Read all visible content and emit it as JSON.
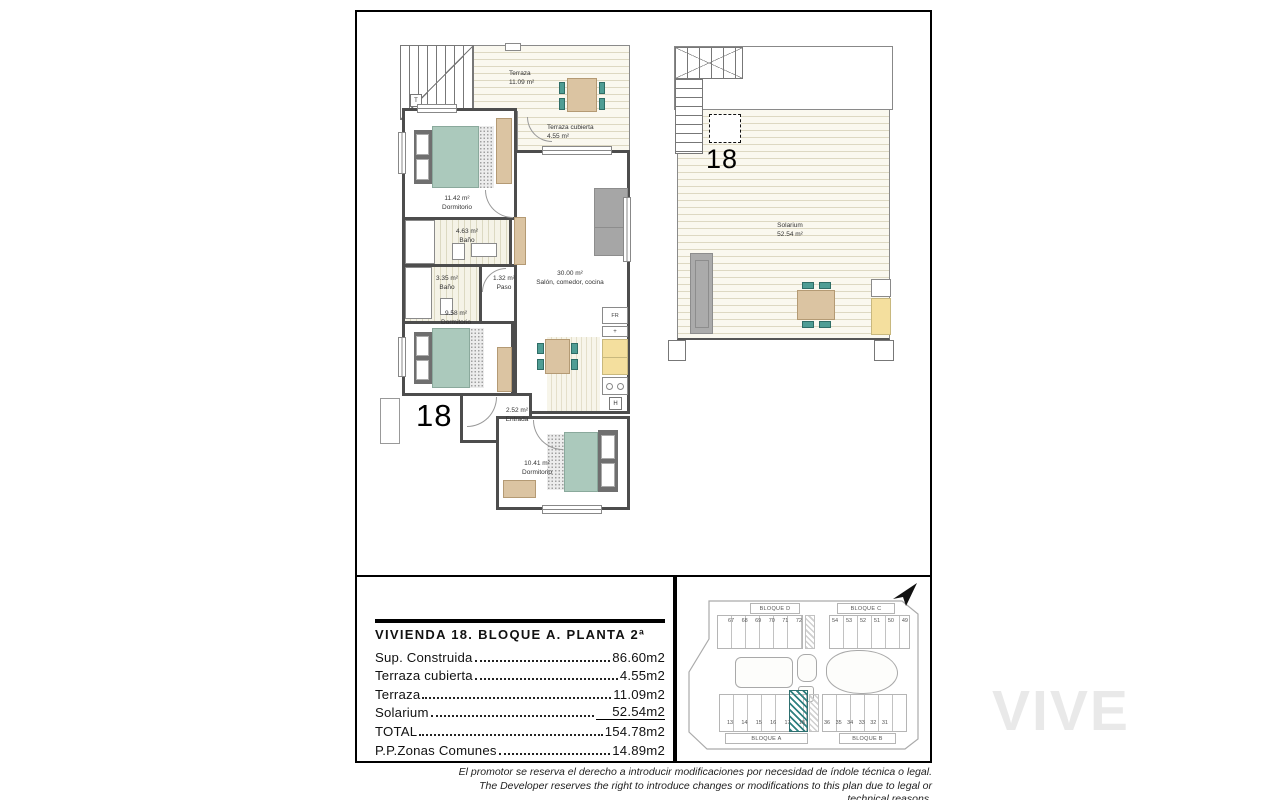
{
  "watermark": "VIVE",
  "main_plan": {
    "unit_label": "18",
    "stair_label": "T",
    "rooms": {
      "terraza": {
        "name": "Terraza",
        "area": "11.09 m²"
      },
      "terraza_cubierta": {
        "name": "Terraza cubierta",
        "area": "4.55 m²"
      },
      "dormitorio1": {
        "name": "Dormitorio",
        "area": "11.42 m²"
      },
      "bano1": {
        "name": "Baño",
        "area": "4.63 m²"
      },
      "bano2": {
        "name": "Baño",
        "area": "3.35 m²"
      },
      "paso": {
        "name": "Paso",
        "area": "1.32 m²"
      },
      "salon": {
        "name": "Salón, comedor, cocina",
        "area": "30.00 m²"
      },
      "dormitorio2": {
        "name": "Dormitorio",
        "area": "9.58 m²"
      },
      "entrada": {
        "name": "Entrada",
        "area": "2.52 m²"
      },
      "dormitorio3": {
        "name": "Dormitorio",
        "area": "10.41 m²"
      }
    },
    "kitchen_labels": {
      "fridge": "FR",
      "counter": "+",
      "water_heater": "H"
    }
  },
  "solarium_plan": {
    "unit_label": "18",
    "name": "Solarium",
    "area": "52.54 m²"
  },
  "summary": {
    "title": "VIVIENDA 18. BLOQUE A. PLANTA 2ª",
    "rows": [
      {
        "label": "Sup. Construida",
        "value": "86.60m2"
      },
      {
        "label": "Terraza cubierta",
        "value": "4.55m2"
      },
      {
        "label": "Terraza",
        "value": "11.09m2"
      },
      {
        "label": "Solarium",
        "value": "52.54m2"
      },
      {
        "label": "TOTAL",
        "value": "154.78m2"
      },
      {
        "label": "P.P.Zonas Comunes",
        "value": "14.89m2"
      }
    ]
  },
  "site_plan": {
    "blocks": {
      "d": {
        "name": "BLOQUE D",
        "units": [
          "67",
          "68",
          "69",
          "70",
          "71",
          "72"
        ]
      },
      "c": {
        "name": "BLOQUE C",
        "units": [
          "54",
          "53",
          "52",
          "51",
          "50",
          "49"
        ]
      },
      "a": {
        "name": "BLOQUE A",
        "units": [
          "13",
          "14",
          "15",
          "16",
          "17",
          "18"
        ]
      },
      "b": {
        "name": "BLOQUE B",
        "units": [
          "36",
          "35",
          "34",
          "33",
          "32",
          "31"
        ]
      }
    },
    "highlighted_unit": "18"
  },
  "footer": {
    "line_es": "El promotor se reserva el derecho a introducir modificaciones por necesidad de índole técnica o legal.",
    "line_en": "The Developer reserves the right to introduce changes or modifications to this plan due to legal or technical reasons."
  },
  "colors": {
    "bed": "#abc9bc",
    "wood": "#dbc4a2",
    "chair_teal": "#4f9d94",
    "cabinet_yellow": "#f4df9e",
    "sofa_gray": "#a6a6a6",
    "highlight_hatch": "#2f8080",
    "wall": "#4d4d4d"
  }
}
